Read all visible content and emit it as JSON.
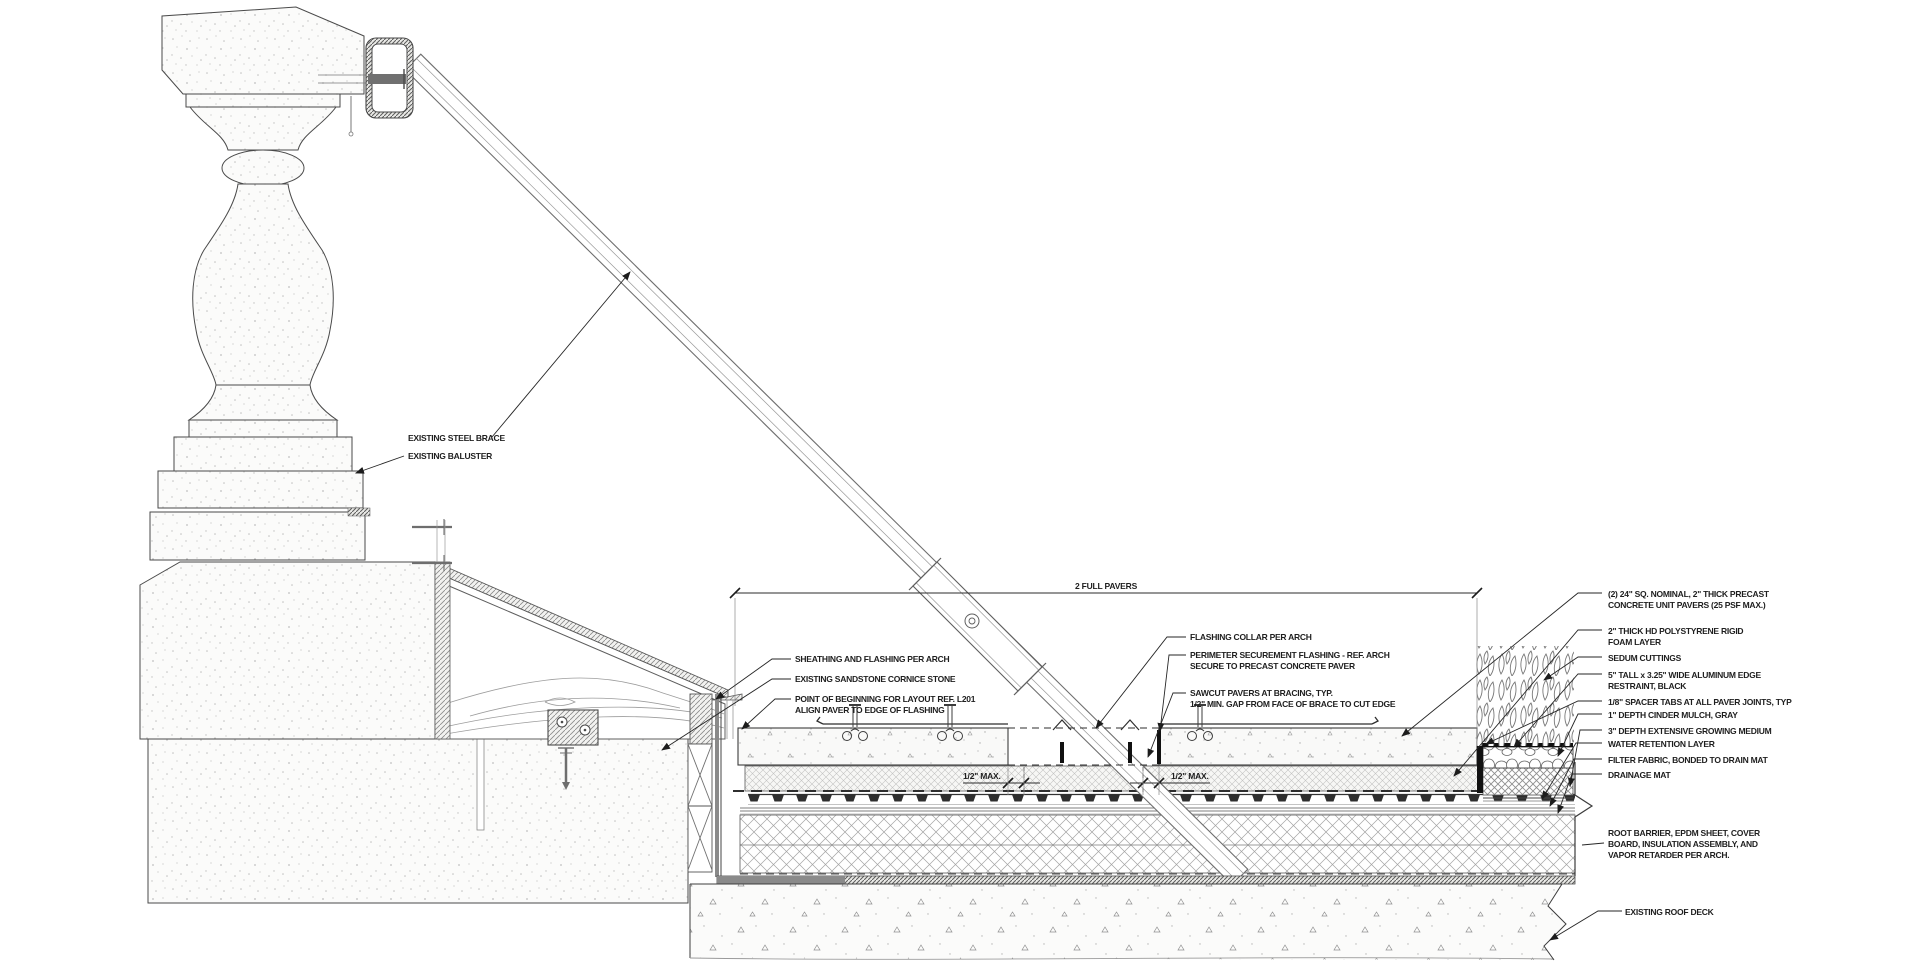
{
  "dims": {
    "full_pavers": "2 FULL PAVERS",
    "gap_left": "1/2\" MAX.",
    "gap_right": "1/2\" MAX."
  },
  "labels": {
    "steel_brace": {
      "lines": [
        "EXISTING STEEL BRACE"
      ]
    },
    "baluster": {
      "lines": [
        "EXISTING BALUSTER"
      ]
    },
    "sheathing": {
      "lines": [
        "SHEATHING AND FLASHING PER ARCH"
      ]
    },
    "cornice": {
      "lines": [
        "EXISTING SANDSTONE CORNICE STONE"
      ]
    },
    "pob": {
      "lines": [
        "POINT OF BEGINNING FOR LAYOUT REF. L201",
        "ALIGN PAVER TO EDGE OF FLASHING"
      ]
    },
    "flashing_collar": {
      "lines": [
        "FLASHING COLLAR PER ARCH"
      ]
    },
    "perimeter": {
      "lines": [
        "PERIMETER SECUREMENT FLASHING - REF. ARCH",
        "SECURE TO PRECAST CONCRETE PAVER"
      ]
    },
    "sawcut": {
      "lines": [
        "SAWCUT PAVERS AT BRACING, TYP.",
        "1/2\" MIN. GAP FROM FACE OF BRACE TO CUT EDGE"
      ]
    },
    "pavers": {
      "lines": [
        "(2) 24\" SQ. NOMINAL, 2\" THICK PRECAST",
        "CONCRETE UNIT PAVERS (25 PSF MAX.)"
      ]
    },
    "foam": {
      "lines": [
        "2\" THICK HD POLYSTYRENE RIGID",
        "FOAM LAYER"
      ]
    },
    "sedum": {
      "lines": [
        "SEDUM CUTTINGS"
      ]
    },
    "edge_restraint": {
      "lines": [
        "5\" TALL x 3.25\" WIDE ALUMINUM EDGE",
        "RESTRAINT, BLACK"
      ]
    },
    "spacer_tabs": {
      "lines": [
        "1/8\" SPACER TABS AT ALL PAVER JOINTS, TYP"
      ]
    },
    "mulch": {
      "lines": [
        "1\" DEPTH CINDER MULCH, GRAY"
      ]
    },
    "growing_medium": {
      "lines": [
        "3\" DEPTH EXTENSIVE GROWING MEDIUM"
      ]
    },
    "water_retention": {
      "lines": [
        "WATER RETENTION LAYER"
      ]
    },
    "filter_fabric": {
      "lines": [
        "FILTER FABRIC, BONDED TO DRAIN MAT"
      ]
    },
    "drainage_mat": {
      "lines": [
        "DRAINAGE MAT"
      ]
    },
    "root_barrier": {
      "lines": [
        "ROOT BARRIER, EPDM SHEET, COVER",
        "BOARD, INSULATION ASSEMBLY, AND",
        "VAPOR RETARDER PER ARCH."
      ]
    },
    "roof_deck": {
      "lines": [
        "EXISTING ROOF DECK"
      ]
    }
  },
  "colors": {
    "line": "#3c3c3c",
    "flashing_gray": "#8a8a8a",
    "black_elements": "#111111"
  }
}
